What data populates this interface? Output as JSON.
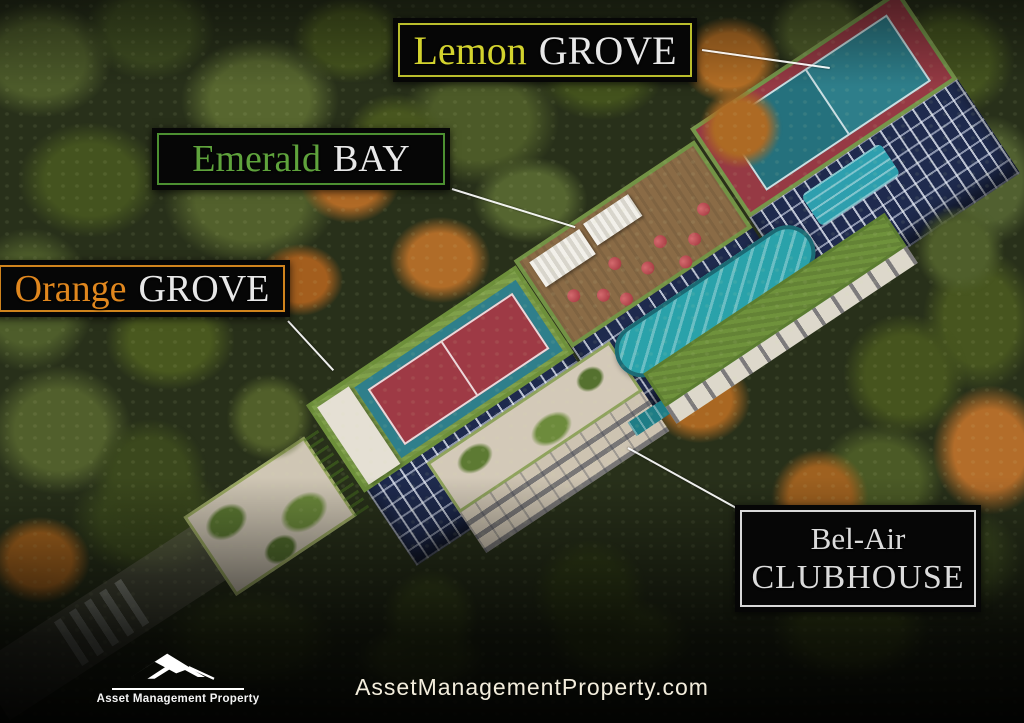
{
  "scene": {
    "description": "Aerial dusk rendering of a forested condominium development with labeled buildings",
    "palette": {
      "forest_green": "#4c5a2a",
      "autumn_orange": "#b06a26",
      "facade_navy": "#26335a",
      "roof_grass": "#7fa04a",
      "tennis_red": "#9e3a45",
      "tennis_teal": "#2f7f8b",
      "pool_teal": "#2aa2aa",
      "label_background": "#060606",
      "leader_line": "#ffffff"
    }
  },
  "labels": {
    "lemon_grove": {
      "accent": "Lemon",
      "rest": "GROVE",
      "accent_color": "#d3d32e",
      "border_color": "#b9bd2c"
    },
    "emerald_bay": {
      "accent": "Emerald",
      "rest": "BAY",
      "accent_color": "#5fa33c",
      "border_color": "#4c8f31"
    },
    "orange_grove": {
      "accent": "Orange",
      "rest": "GROVE",
      "accent_color": "#e0871e",
      "border_color": "#cf831d"
    },
    "bel_air": {
      "line1": "Bel-Air",
      "line2": "CLUBHOUSE",
      "text_color": "#dcdcdc",
      "border_color": "#d8d8d8"
    }
  },
  "footer": {
    "logo_name": "Asset Management Property",
    "website": "AssetManagementProperty.com"
  }
}
